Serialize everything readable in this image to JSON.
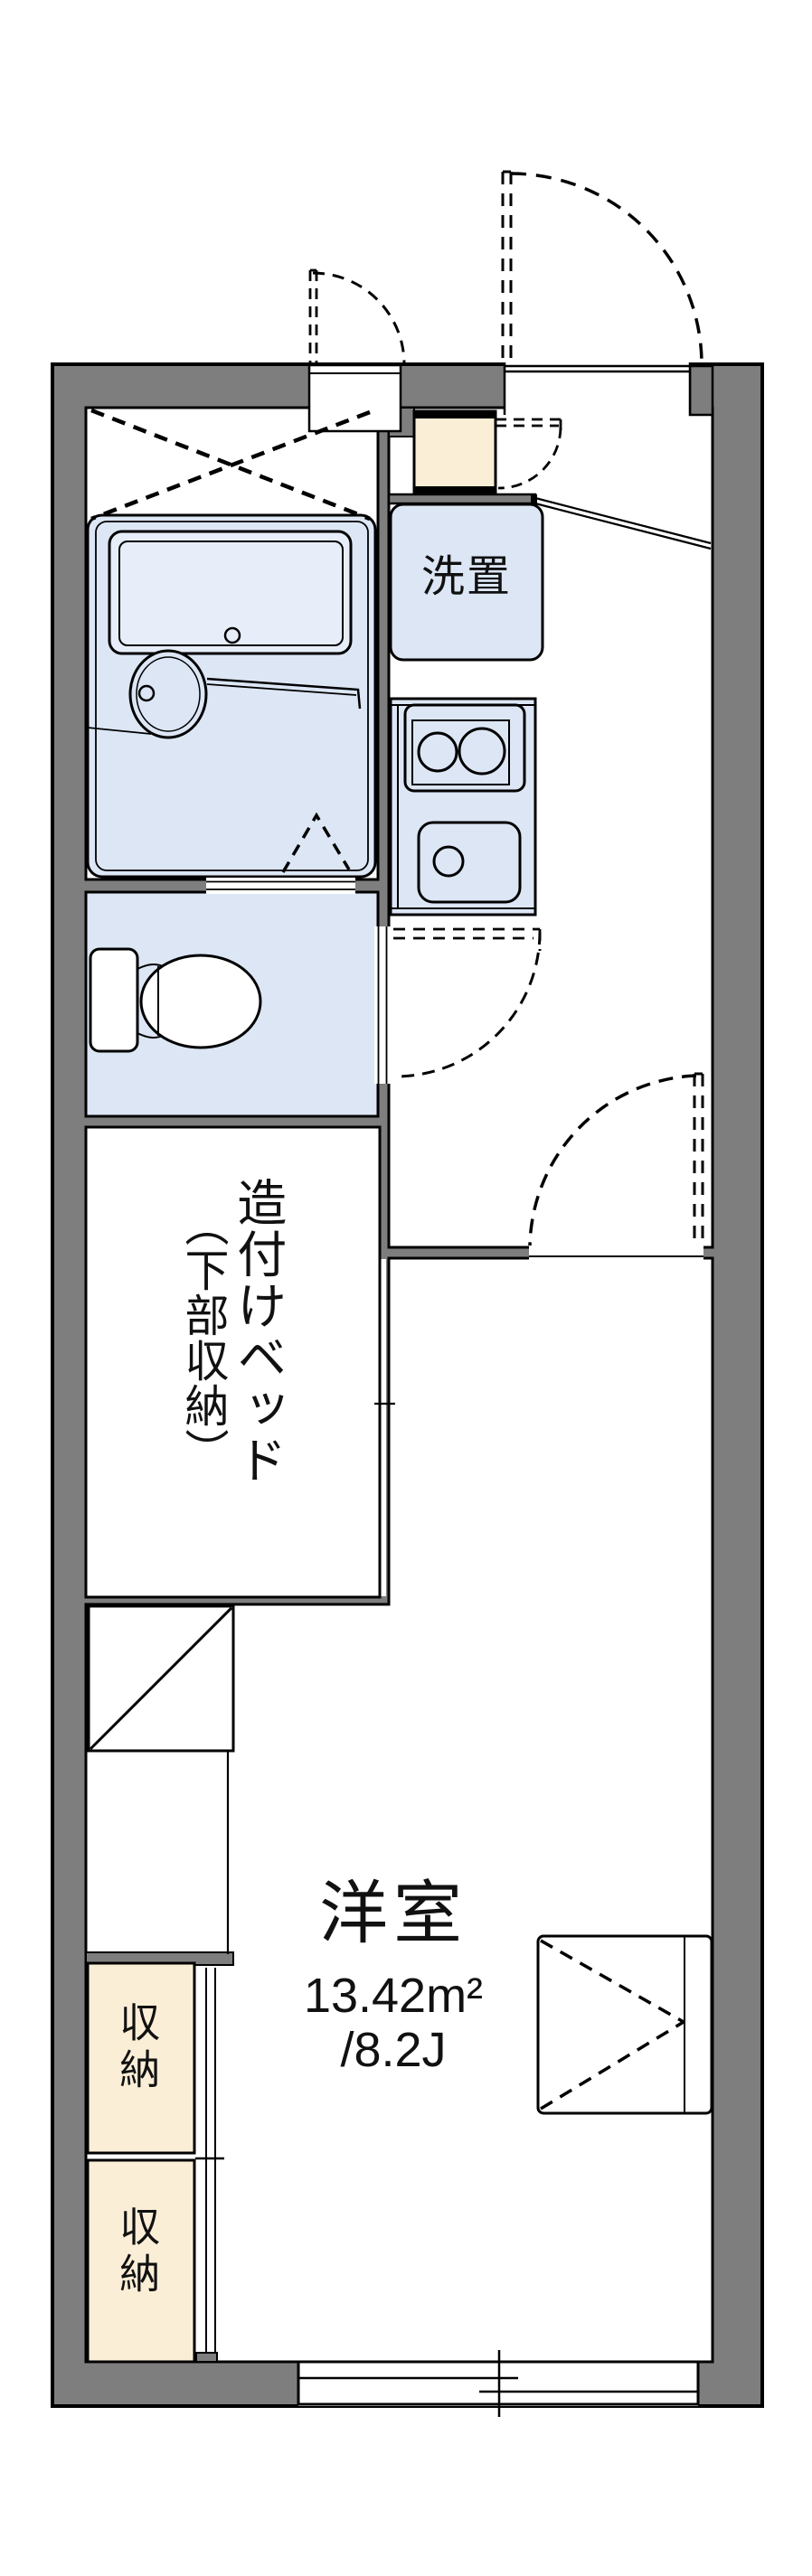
{
  "plan": {
    "title": "1K apartment floor plan",
    "labels": {
      "laundry": "洗置",
      "bed_main": "造付けベッド",
      "bed_sub": "（下部収納）",
      "room_name": "洋室",
      "room_area_sqm": "13.42m²",
      "room_area_jo": "/8.2J",
      "storage_upper": "収納",
      "storage_lower": "収納"
    },
    "colors": {
      "wall_gray": "#7E7E7E",
      "room_blue": "#DCE6F5",
      "tub_blue": "#E7EEF9",
      "closet_cream": "#FBEED7",
      "line_black": "#000000",
      "background": "#FFFFFF"
    }
  }
}
